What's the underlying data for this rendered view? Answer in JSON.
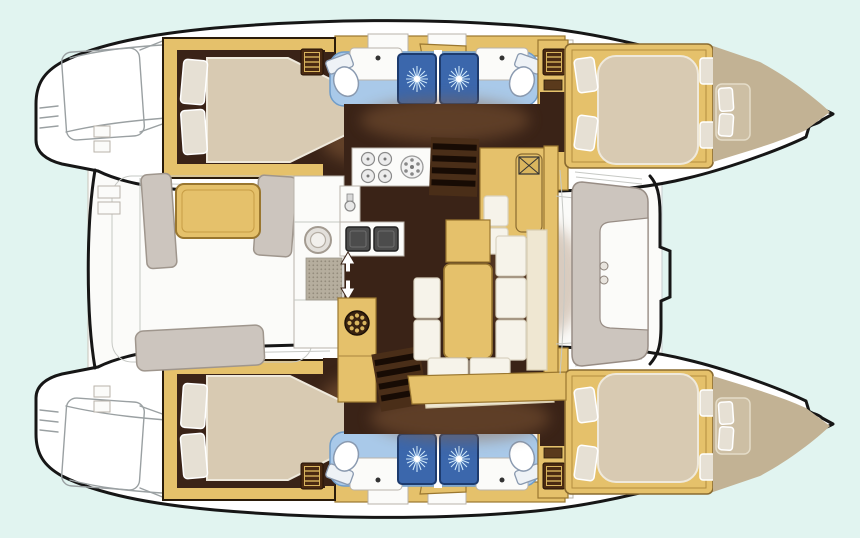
{
  "diagram": {
    "type": "catamaran-floorplan",
    "orientation": "bows-right",
    "rooms": [
      {
        "id": "upper-aft-cabin",
        "label": "double berth cabin"
      },
      {
        "id": "upper-bathroom",
        "label": "head with shower and toilet"
      },
      {
        "id": "upper-forward-cabin",
        "label": "double berth cabin"
      },
      {
        "id": "lower-aft-cabin",
        "label": "double berth cabin"
      },
      {
        "id": "lower-bathroom",
        "label": "head with shower and toilet"
      },
      {
        "id": "lower-forward-cabin",
        "label": "double berth cabin"
      },
      {
        "id": "saloon",
        "label": "saloon with galley and dinette"
      },
      {
        "id": "aft-cockpit",
        "label": "cockpit with table and benches"
      },
      {
        "id": "forward-cockpit",
        "label": "bow seating"
      }
    ],
    "fixtures": [
      "bed",
      "pillows",
      "toilet",
      "sink",
      "shower",
      "stove-4-burner",
      "round-hob",
      "double-sink",
      "fridge-washer",
      "companionway-stairs",
      "ladder-hatch-icon",
      "vent-fan-icon",
      "dinette-table",
      "cockpit-table",
      "helm-wheel"
    ]
  },
  "palette": {
    "bg": "#e1f4f0",
    "ink": "#161616",
    "line": "#9aa0a2",
    "hull": "#ffffff",
    "teak": "#e5c16b",
    "teakDark": "#9a7730",
    "teakDeep": "#5a3a1c",
    "floorDark": "#3a2317",
    "stairBg": "#4a2e18",
    "stairBar": "#170b04",
    "shadow": "#8a5f3a",
    "mattress": "#d8cab2",
    "mattressEdge": "#efe9dc",
    "pillow": "#e6e0d4",
    "bathFloor": "#a9c9e9",
    "bathEdge": "#6f9cc9",
    "shower": "#3b67ac",
    "showerEdge": "#1d3b6e",
    "spray": "#cde7fa",
    "white": "#fbfbf9",
    "greySeat": "#ccc5be",
    "greySeatEdge": "#9f968d",
    "cream": "#efe7d2",
    "creamEdge": "#d8cdb0",
    "cushion": "#f6f3ea",
    "bowDeck": "#c2b294",
    "bowSeat": "#cdbfa4",
    "applGrey": "#e3e0db",
    "matGrey": "#b6ae9e",
    "matDot": "#948c7c",
    "gold": "#d9b55e",
    "hatchBrown": "#4a2a12"
  }
}
